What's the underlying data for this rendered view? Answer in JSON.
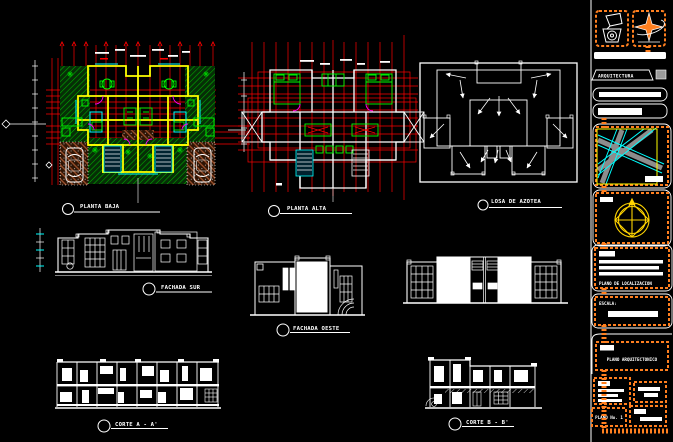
{
  "canvas": {
    "background": "#000000"
  },
  "palette": {
    "red": "#ff0000",
    "yellow": "#ffff00",
    "green": "#00d200",
    "bright_green": "#00ff00",
    "cyan": "#00ffff",
    "magenta": "#ff00ff",
    "orange": "#ff7f1f",
    "brown": "#a0522d",
    "white": "#ffffff",
    "gray": "#9a9a9a",
    "map_gray": "#8c8c8c",
    "compass_yellow": "#ffd400"
  },
  "views": {
    "planta_baja": {
      "label": "PLANTA BAJA"
    },
    "planta_alta": {
      "label": "PLANTA ALTA"
    },
    "losa_azotea": {
      "label": "LOSA DE AZOTEA"
    },
    "fachada_sur": {
      "label": "FACHADA SUR"
    },
    "fachada_oeste": {
      "label": "FACHADA OESTE"
    },
    "corte_a": {
      "label": "CORTE  A - A'"
    },
    "corte_b": {
      "label": "CORTE  B - B'"
    }
  },
  "titleblock": {
    "banner": "ARQUITECTURA",
    "location_caption": "PLANO DE LOCALIZACION",
    "scale_label": "ESCALA:",
    "sheet_title": "PLANO ARQUITECTONICO",
    "sheet_number": "PLANO No. 1"
  }
}
